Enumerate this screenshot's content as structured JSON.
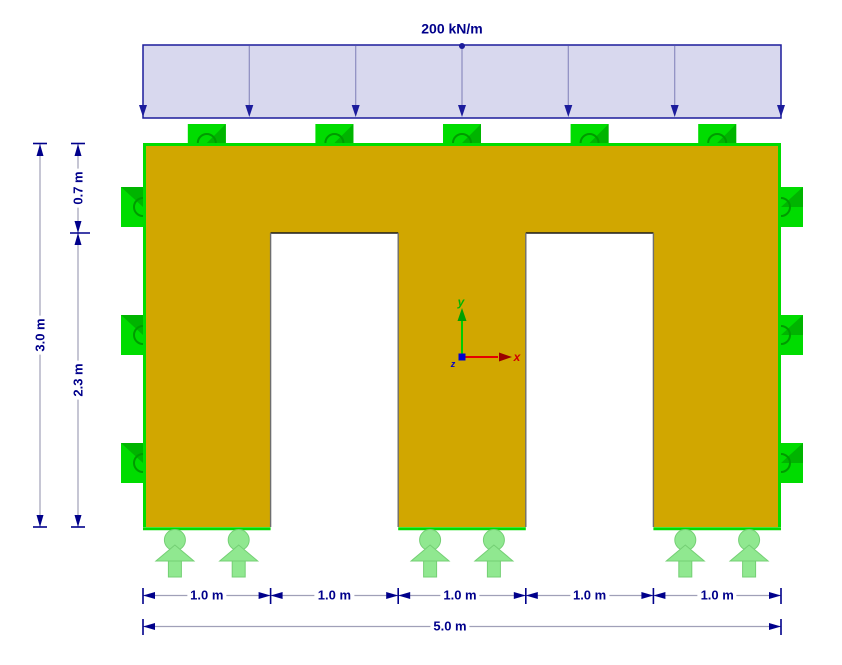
{
  "load": {
    "value_label": "200 kN/m"
  },
  "dimensions": {
    "height_total": "3.0 m",
    "height_upper": "0.7 m",
    "height_lower": "2.3 m",
    "width_segments": [
      "1.0 m",
      "1.0 m",
      "1.0 m",
      "1.0 m",
      "1.0 m"
    ],
    "width_total": "5.0 m"
  },
  "axes": {
    "x_label": "x",
    "y_label": "y",
    "z_label": "z"
  },
  "colors": {
    "surface": "#d1a700",
    "line_support": "#00dc00",
    "line_support_arc": "#009b00",
    "nodal_support": "#90e890",
    "annotation": "#00008b",
    "dimension_line": "#a0a0b8",
    "load_fill": "#d8d8ee",
    "load_border": "#1c1c9c",
    "axis_x": "#e00000",
    "axis_y": "#00c000",
    "axis_z": "#0000d0"
  }
}
